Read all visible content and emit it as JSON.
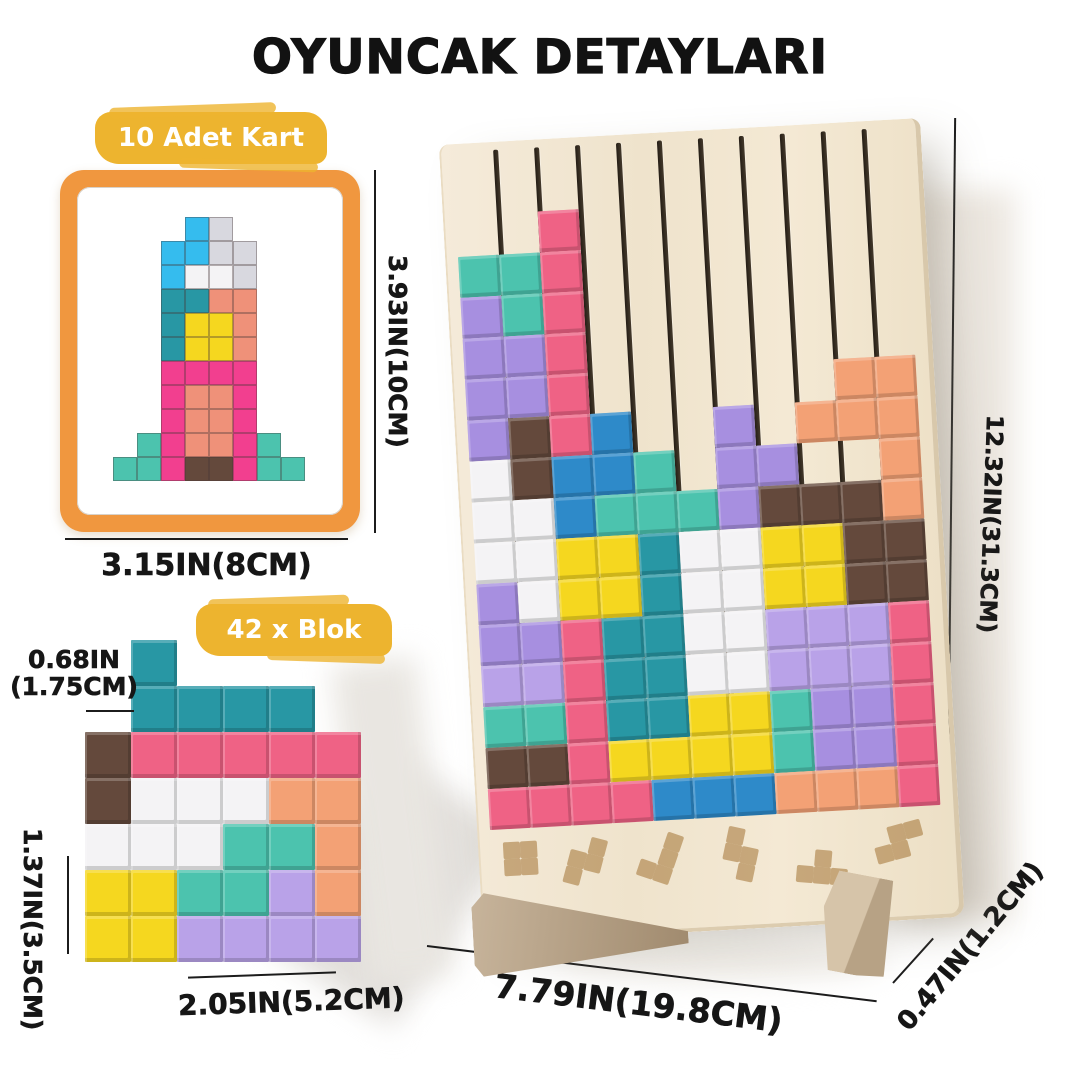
{
  "title": "OYUNCAK DETAYLARI",
  "card_section": {
    "badge": "10 Adet Kart",
    "height_label": "3.93IN(10CM)",
    "width_label": "3.15IN(8CM)",
    "figure_grid": [
      "...CG...",
      "..CCGG..",
      "..CWWG..",
      "..TTSS..",
      "..TYYS..",
      "..TYYS..",
      "..KKKK..",
      "..KSSK..",
      "..KSSK..",
      ".MKSSKM.",
      "MMKNNKMM"
    ]
  },
  "blocks_section": {
    "badge": "42 x Blok",
    "thickness_label_line1": "0.68IN",
    "thickness_label_line2": "(1.75CM)",
    "height_label": "1.37IN(3.5CM)",
    "width_label": "2.05IN(5.2CM)",
    "figure_grid": [
      ".T....",
      ".TTTT.",
      "NRRRRR",
      "NWWWOO",
      "WWWMMO",
      "YYMMVO",
      "YYVVVV"
    ]
  },
  "board_section": {
    "height_label": "12.32IN(31.3CM)",
    "width_label": "7.79IN(19.8CM)",
    "depth_label": "0.47IN(1.2CM)",
    "slot_count": 10,
    "figure_grid": [
      "..R........",
      "MMR........",
      "PMR........",
      "PPR........",
      "PPR......OO",
      "PNRB..P.OOO",
      "WNBBM.PP..O",
      "WWBMMMPNNNO",
      "WWYYTWWYYNN",
      "PWYYTWWYYNN",
      "PPRTTWWVVVR",
      "VVRTTWWVVVR",
      "MMRTTYYMPPR",
      "NNRYYYYMPPR",
      "RRRRBBBOOOR"
    ],
    "stamps": [
      {
        "rows": [
          "11",
          "11"
        ],
        "x": 25,
        "y": 700,
        "rot": 0
      },
      {
        "rows": [
          "01",
          "11",
          "10"
        ],
        "x": 98,
        "y": 694,
        "rot": 18
      },
      {
        "rows": [
          "01",
          "01",
          "11"
        ],
        "x": 175,
        "y": 692,
        "rot": 22
      },
      {
        "rows": [
          "10",
          "11",
          "01"
        ],
        "x": 252,
        "y": 696,
        "rot": 15
      },
      {
        "rows": [
          "010",
          "111"
        ],
        "x": 320,
        "y": 722,
        "rot": 8
      },
      {
        "rows": [
          "011",
          "110"
        ],
        "x": 392,
        "y": 710,
        "rot": -12
      }
    ]
  },
  "palette": {
    "C": "#35BCEE",
    "G": "#D8D8DF",
    "W": "#F4F3F5",
    "T": "#2897A4",
    "S": "#EF9179",
    "Y": "#F5D71F",
    "K": "#F23F8F",
    "N": "#64493C",
    "M": "#4CC3AE",
    "P": "#A78FE0",
    "B": "#2E8AC9",
    "O": "#F3A175",
    "V": "#B9A2E8",
    "R": "#EF6285"
  },
  "colors": {
    "badge_bg": "#EDB42F",
    "badge_text": "#FFFFFF",
    "card_border": "#F0973F",
    "wood": "#F2E7D2",
    "groove": "#39302A",
    "stamp": "#A97B3F",
    "line": "#1C1C1C",
    "title": "#121212"
  }
}
